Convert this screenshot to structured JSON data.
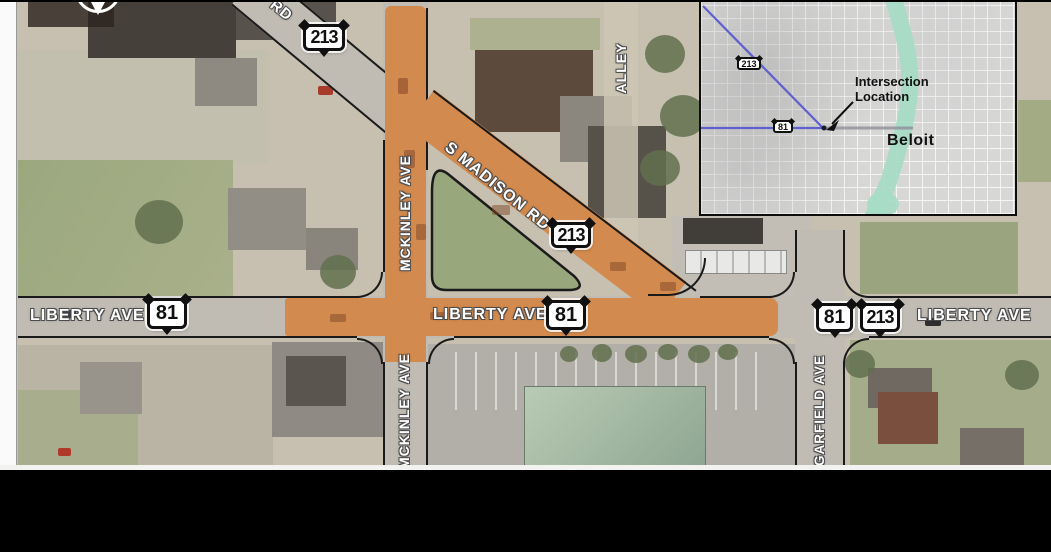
{
  "map": {
    "labels": {
      "liberty_ave": "LIBERTY AVE",
      "s_madison_rd": "S MADISON RD",
      "s_madison_rd_fragment": "RD",
      "mckinley_ave": "MCKINLEY AVE",
      "garfield_ave": "GARFIELD AVE",
      "alley": "ALLEY"
    },
    "shields": {
      "route_81": "81",
      "route_213": "213"
    },
    "highlight_color": "#d28a4e"
  },
  "inset_map": {
    "callout_label": "Intersection Location",
    "city_label": "Beloit",
    "shields": {
      "route_81": "81",
      "route_213": "213"
    },
    "river_color": "#a6dbc5",
    "highway_line_color": "#5f5fd0"
  }
}
